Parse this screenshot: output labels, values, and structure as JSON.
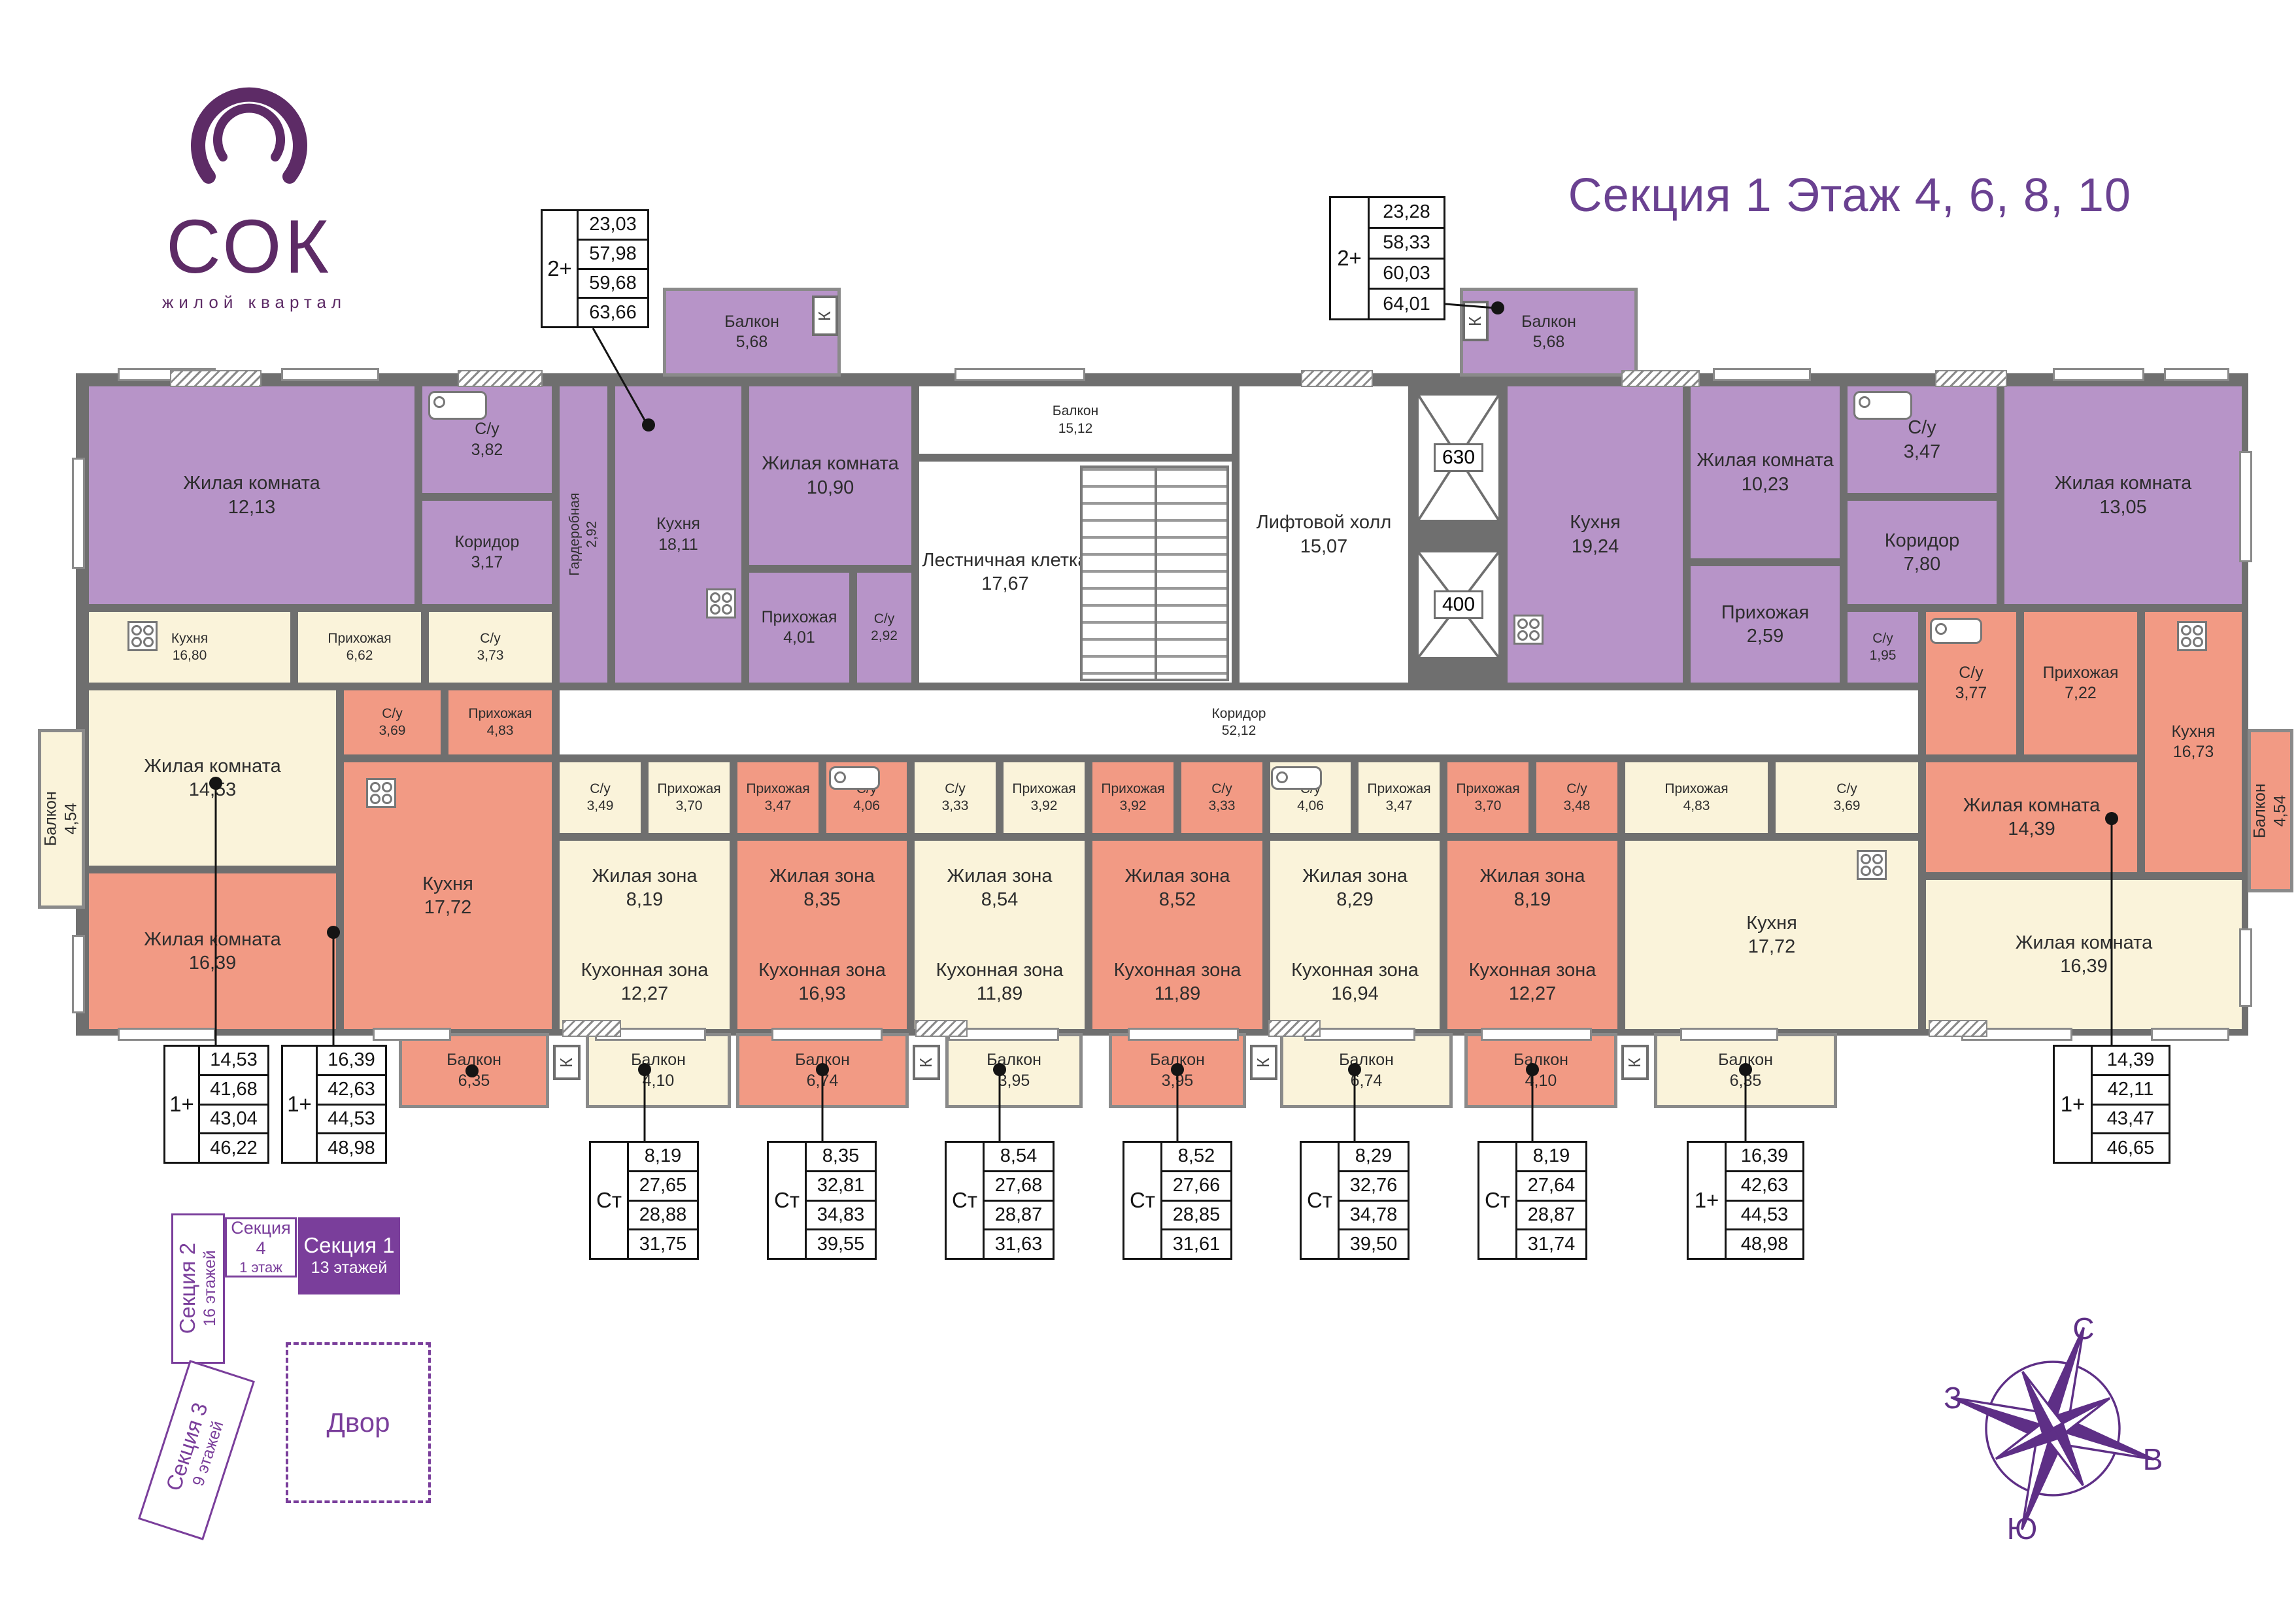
{
  "header": {
    "logo_text": "СОК",
    "logo_tagline": "жилой квартал",
    "title": "Секция 1  Этаж 4, 6, 8, 10"
  },
  "rooms": [
    {
      "id": "zk1213",
      "name": "Жилая комната",
      "area": "12,13",
      "fill": "purple"
    },
    {
      "id": "su382",
      "name": "С/у",
      "area": "3,82",
      "fill": "purple"
    },
    {
      "id": "kor317",
      "name": "Коридор",
      "area": "3,17",
      "fill": "purple"
    },
    {
      "id": "gard292",
      "name": "Гардеробная",
      "area": "2,92",
      "fill": "purple",
      "vertical": true
    },
    {
      "id": "kuh1811",
      "name": "Кухня",
      "area": "18,11",
      "fill": "purple"
    },
    {
      "id": "zk1090",
      "name": "Жилая комната",
      "area": "10,90",
      "fill": "purple"
    },
    {
      "id": "prih401",
      "name": "Прихожая",
      "area": "4,01",
      "fill": "purple"
    },
    {
      "id": "su292",
      "name": "С/у",
      "area": "2,92",
      "fill": "purple"
    },
    {
      "id": "balk1512",
      "name": "Балкон",
      "area": "15,12",
      "fill": "white"
    },
    {
      "id": "lk1767",
      "name": "Лестничная клетка",
      "area": "17,67",
      "fill": "white"
    },
    {
      "id": "lift1507",
      "name": "Лифтовой холл",
      "area": "15,07",
      "fill": "white"
    },
    {
      "id": "kor5212",
      "name": "Коридор",
      "area": "52,12",
      "fill": "white"
    },
    {
      "id": "kuh1924",
      "name": "Кухня",
      "area": "19,24",
      "fill": "purple"
    },
    {
      "id": "zk1023",
      "name": "Жилая комната",
      "area": "10,23",
      "fill": "purple"
    },
    {
      "id": "su347",
      "name": "С/у",
      "area": "3,47",
      "fill": "purple"
    },
    {
      "id": "kor780",
      "name": "Коридор",
      "area": "7,80",
      "fill": "purple"
    },
    {
      "id": "prih259",
      "name": "Прихожая",
      "area": "2,59",
      "fill": "purple"
    },
    {
      "id": "su195",
      "name": "С/у",
      "area": "1,95",
      "fill": "purple"
    },
    {
      "id": "zk1305",
      "name": "Жилая комната",
      "area": "13,05",
      "fill": "purple"
    },
    {
      "id": "kuh1680",
      "name": "Кухня",
      "area": "16,80",
      "fill": "cream"
    },
    {
      "id": "prih662",
      "name": "Прихожая",
      "area": "6,62",
      "fill": "cream"
    },
    {
      "id": "su373",
      "name": "С/у",
      "area": "3,73",
      "fill": "cream"
    },
    {
      "id": "zk1453",
      "name": "Жилая комната",
      "area": "14,53",
      "fill": "cream"
    },
    {
      "id": "su369L",
      "name": "С/у",
      "area": "3,69",
      "fill": "salmon"
    },
    {
      "id": "prih483L",
      "name": "Прихожая",
      "area": "4,83",
      "fill": "salmon"
    },
    {
      "id": "kuh1772L",
      "name": "Кухня",
      "area": "17,72",
      "fill": "salmon"
    },
    {
      "id": "zk1639L",
      "name": "Жилая комната",
      "area": "16,39",
      "fill": "salmon"
    },
    {
      "id": "s1su",
      "name": "С/у",
      "area": "3,49",
      "fill": "cream"
    },
    {
      "id": "s1prih",
      "name": "Прихожая",
      "area": "3,70",
      "fill": "cream"
    },
    {
      "id": "s1zone",
      "name": "Жилая зона",
      "area": "8,19",
      "name2": "Кухонная зона",
      "area2": "12,27",
      "fill": "cream"
    },
    {
      "id": "s2prih",
      "name": "Прихожая",
      "area": "3,47",
      "fill": "salmon"
    },
    {
      "id": "s2su",
      "name": "С/у",
      "area": "4,06",
      "fill": "salmon"
    },
    {
      "id": "s2zone",
      "name": "Жилая зона",
      "area": "8,35",
      "name2": "Кухонная зона",
      "area2": "16,93",
      "fill": "salmon"
    },
    {
      "id": "s3su",
      "name": "С/у",
      "area": "3,33",
      "fill": "cream"
    },
    {
      "id": "s3prih",
      "name": "Прихожая",
      "area": "3,92",
      "fill": "cream"
    },
    {
      "id": "s3zone",
      "name": "Жилая зона",
      "area": "8,54",
      "name2": "Кухонная зона",
      "area2": "11,89",
      "fill": "cream"
    },
    {
      "id": "s4prih",
      "name": "Прихожая",
      "area": "3,92",
      "fill": "salmon"
    },
    {
      "id": "s4su",
      "name": "С/у",
      "area": "3,33",
      "fill": "salmon"
    },
    {
      "id": "s4zone",
      "name": "Жилая зона",
      "area": "8,52",
      "name2": "Кухонная зона",
      "area2": "11,89",
      "fill": "salmon"
    },
    {
      "id": "s5su",
      "name": "С/у",
      "area": "4,06",
      "fill": "cream"
    },
    {
      "id": "s5prih",
      "name": "Прихожая",
      "area": "3,47",
      "fill": "cream"
    },
    {
      "id": "s5zone",
      "name": "Жилая зона",
      "area": "8,29",
      "name2": "Кухонная зона",
      "area2": "16,94",
      "fill": "cream"
    },
    {
      "id": "s6prih",
      "name": "Прихожая",
      "area": "3,70",
      "fill": "salmon"
    },
    {
      "id": "s6su",
      "name": "С/у",
      "area": "3,48",
      "fill": "salmon"
    },
    {
      "id": "s6zone",
      "name": "Жилая зона",
      "area": "8,19",
      "name2": "Кухонная зона",
      "area2": "12,27",
      "fill": "salmon"
    },
    {
      "id": "prih483R",
      "name": "Прихожая",
      "area": "4,83",
      "fill": "cream"
    },
    {
      "id": "su369R",
      "name": "С/у",
      "area": "3,69",
      "fill": "cream"
    },
    {
      "id": "kuh1772R",
      "name": "Кухня",
      "area": "17,72",
      "fill": "cream"
    },
    {
      "id": "zk1639R",
      "name": "Жилая комната",
      "area": "16,39",
      "fill": "cream"
    },
    {
      "id": "su377",
      "name": "С/у",
      "area": "3,77",
      "fill": "salmon"
    },
    {
      "id": "prih722",
      "name": "Прихожая",
      "area": "7,22",
      "fill": "salmon"
    },
    {
      "id": "kuh1673",
      "name": "Кухня",
      "area": "16,73",
      "fill": "salmon"
    },
    {
      "id": "zk1439",
      "name": "Жилая комната",
      "area": "14,39",
      "fill": "salmon"
    }
  ],
  "balconies": [
    {
      "id": "b568L",
      "name": "Балкон",
      "area": "5,68",
      "fill": "purple"
    },
    {
      "id": "b568R",
      "name": "Балкон",
      "area": "5,68",
      "fill": "purple"
    },
    {
      "id": "b454L",
      "name": "Балкон",
      "area": "4,54",
      "fill": "cream",
      "vertical": true
    },
    {
      "id": "b454R",
      "name": "Балкон",
      "area": "4,54",
      "fill": "salmon",
      "vertical": true
    },
    {
      "id": "b635L",
      "name": "Балкон",
      "area": "6,35",
      "fill": "salmon"
    },
    {
      "id": "b410a",
      "name": "Балкон",
      "area": "4,10",
      "fill": "cream"
    },
    {
      "id": "b674a",
      "name": "Балкон",
      "area": "6,74",
      "fill": "salmon"
    },
    {
      "id": "b395a",
      "name": "Балкон",
      "area": "3,95",
      "fill": "cream"
    },
    {
      "id": "b395b",
      "name": "Балкон",
      "area": "3,95",
      "fill": "salmon"
    },
    {
      "id": "b674b",
      "name": "Балкон",
      "area": "6,74",
      "fill": "cream"
    },
    {
      "id": "b410b",
      "name": "Балкон",
      "area": "4,10",
      "fill": "salmon"
    },
    {
      "id": "b635R",
      "name": "Балкон",
      "area": "6,35",
      "fill": "cream"
    }
  ],
  "tables": [
    {
      "id": "t2plusL",
      "type": "2+",
      "values": [
        "23,03",
        "57,98",
        "59,68",
        "63,66"
      ]
    },
    {
      "id": "t2plusR",
      "type": "2+",
      "values": [
        "23,28",
        "58,33",
        "60,03",
        "64,01"
      ]
    },
    {
      "id": "t1plusA",
      "type": "1+",
      "values": [
        "14,53",
        "41,68",
        "43,04",
        "46,22"
      ]
    },
    {
      "id": "t1plusB",
      "type": "1+",
      "values": [
        "16,39",
        "42,63",
        "44,53",
        "48,98"
      ]
    },
    {
      "id": "st1",
      "type": "Ст",
      "values": [
        "8,19",
        "27,65",
        "28,88",
        "31,75"
      ]
    },
    {
      "id": "st2",
      "type": "Ст",
      "values": [
        "8,35",
        "32,81",
        "34,83",
        "39,55"
      ]
    },
    {
      "id": "st3",
      "type": "Ст",
      "values": [
        "8,54",
        "27,68",
        "28,87",
        "31,63"
      ]
    },
    {
      "id": "st4",
      "type": "Ст",
      "values": [
        "8,52",
        "27,66",
        "28,85",
        "31,61"
      ]
    },
    {
      "id": "st5",
      "type": "Ст",
      "values": [
        "8,29",
        "32,76",
        "34,78",
        "39,50"
      ]
    },
    {
      "id": "st6",
      "type": "Ст",
      "values": [
        "8,19",
        "27,64",
        "28,87",
        "31,74"
      ]
    },
    {
      "id": "t1plusR",
      "type": "1+",
      "values": [
        "16,39",
        "42,63",
        "44,53",
        "48,98"
      ]
    },
    {
      "id": "t1plusFR",
      "type": "1+",
      "values": [
        "14,39",
        "42,11",
        "43,47",
        "46,65"
      ]
    }
  ],
  "elevators": [
    {
      "id": "elev630",
      "label": "630"
    },
    {
      "id": "elev400",
      "label": "400"
    }
  ],
  "vent_label": "К",
  "site_plan": {
    "sections": [
      {
        "label": "Секция 2",
        "floors": "16 этажей"
      },
      {
        "label": "Секция 3",
        "floors": "9 этажей"
      },
      {
        "label": "Секция 4",
        "floors": "1 этаж"
      },
      {
        "label": "Секция 1",
        "floors": "13 этажей"
      }
    ],
    "yard": "Двор"
  },
  "compass": {
    "north": "С",
    "east": "В",
    "south": "Ю",
    "west": "З"
  },
  "colors": {
    "purple": "#b794c8",
    "cream": "#faf3da",
    "salmon": "#f29a84",
    "wall": "#6f6f6f",
    "brand": "#5d2b66",
    "accent": "#7a3e9b"
  }
}
